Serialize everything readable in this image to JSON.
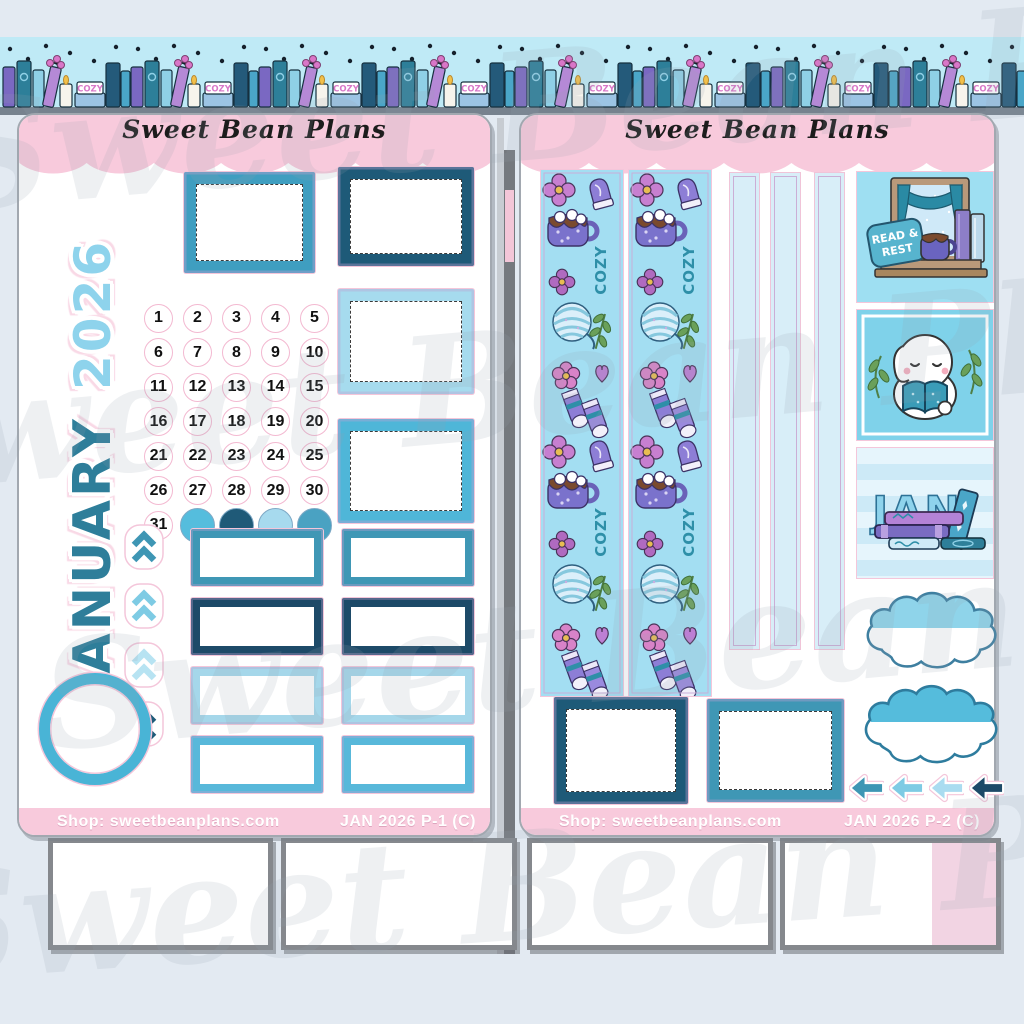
{
  "watermark": "Sweet Bean Plans",
  "palette": {
    "page_background": "#e3eaf2",
    "banner_blue": "#bfeaf6",
    "header_pink": "#f8cadc",
    "month_teal": "#2e7e9a",
    "year_blue": "#8ed3ec",
    "date_circle_outline": "#f3b9d1"
  },
  "banner": {
    "cozy_sign": "COZY"
  },
  "sheet1": {
    "brand": "Sweet Bean Plans",
    "month": "JANUARY",
    "year": "2026",
    "dates": [
      "1",
      "2",
      "3",
      "4",
      "5",
      "6",
      "7",
      "8",
      "9",
      "10",
      "11",
      "12",
      "13",
      "14",
      "15",
      "16",
      "17",
      "18",
      "19",
      "20",
      "21",
      "22",
      "23",
      "24",
      "25",
      "26",
      "27",
      "28",
      "29",
      "30",
      "31"
    ],
    "dot_colors": [
      "#55bddd",
      "#1f5a78",
      "#a7daee",
      "#4aa2c2"
    ],
    "chevron_colors": [
      "#3e96b4",
      "#7ecbe4",
      "#b7e3f2",
      "#1d5a78"
    ],
    "full_box_colors": [
      "#3f9ec0",
      "#1e5a78",
      "#a6dbee",
      "#4fb6d8"
    ],
    "half_box_colors": [
      "#3f97b5",
      "#1d4a68",
      "#a5d7ea",
      "#58b8da"
    ],
    "footer_shop": "Shop: sweetbeanplans.com",
    "footer_code": "JAN 2026 P-1 (C)"
  },
  "sheet2": {
    "brand": "Sweet Bean Plans",
    "washi_cozy": "COZY",
    "pillow_line1": "READ &",
    "pillow_line2": "REST",
    "jan_label": "JAN",
    "cloud_fill_colors": [
      "#8fd4ea",
      "#55bcdc"
    ],
    "arrow_colors": [
      "#3e96b4",
      "#7ecbe4",
      "#aadcf0",
      "#1d4a68"
    ],
    "box_colors": [
      "#1e5a78",
      "#3f97b5"
    ],
    "footer_shop": "Shop: sweetbeanplans.com",
    "footer_code": "JAN 2026 P-2 (C)"
  }
}
